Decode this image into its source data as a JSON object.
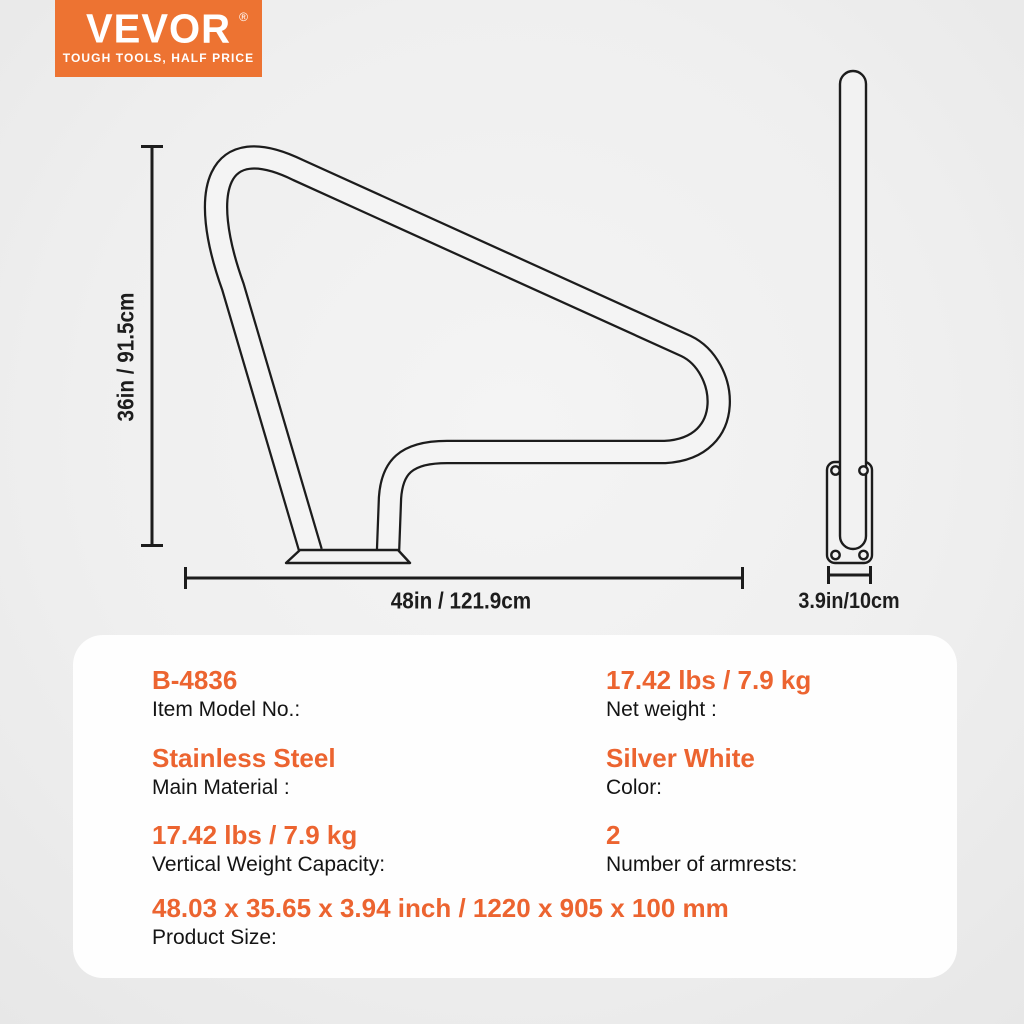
{
  "brand": {
    "name": "VEVOR",
    "reg_mark": "®",
    "tagline": "TOUGH TOOLS, HALF PRICE",
    "brand_color": "#ed7332",
    "text_color": "#ffffff"
  },
  "diagram": {
    "front": {
      "height_label": "36in / 91.5cm",
      "width_label": "48in / 121.9cm"
    },
    "side": {
      "width_label": "3.9in/10cm"
    },
    "line_color": "#1c1c1c"
  },
  "specs": {
    "accent_color": "#ec6430",
    "items": [
      {
        "value": "B-4836",
        "label": "Item Model No.:"
      },
      {
        "value": "17.42 lbs / 7.9 kg",
        "label": "Net weight :"
      },
      {
        "value": "Stainless Steel",
        "label": "Main Material :"
      },
      {
        "value": "Silver White",
        "label": "Color:"
      },
      {
        "value": "17.42 lbs / 7.9 kg",
        "label": "Vertical Weight Capacity:"
      },
      {
        "value": "2",
        "label": "Number of armrests:"
      },
      {
        "value": "48.03 x 35.65 x 3.94 inch / 1220 x 905 x 100 mm",
        "label": "Product Size:"
      }
    ]
  }
}
